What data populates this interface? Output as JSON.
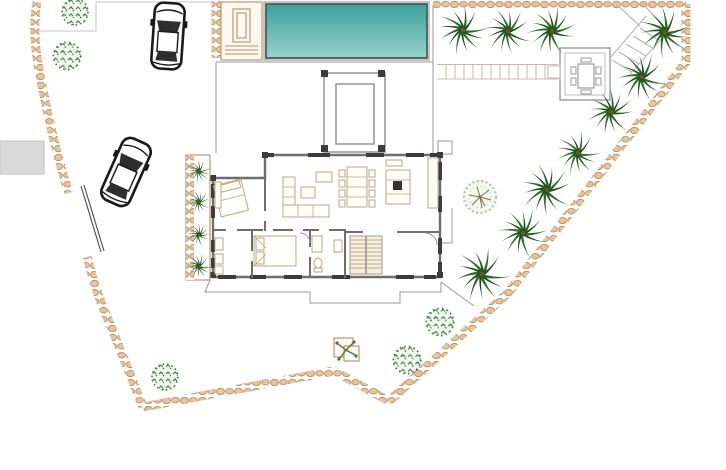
{
  "meta": {
    "title": "Villa site plan with pool and garden",
    "description": "Top-view architectural site plan: villa floor plan with entrance porch, swimming pool, pool house, gazebo, stone boundary wall, driveway with two cars, and palm garden",
    "canvas": {
      "width": 726,
      "height": 470
    }
  },
  "palette": {
    "paper": "#ffffff",
    "pool_top": "#3da09a",
    "pool_bottom": "#96d4cc",
    "pool_edge": "#4f5a5a",
    "stone": "#e6c49c",
    "stone_edge": "#b98e62",
    "wall": "#6e6e6e",
    "wall_dark": "#3c3c3c",
    "furniture": "#b9a88a",
    "palm_green": "#2d6a2a",
    "palm_dark": "#1e4f1e",
    "palm_trunk": "#7a4f26",
    "bush_green": "#3f7a3f",
    "tree_light": "#a9cfa4",
    "branch_brown": "#8a6b4a",
    "car_outline": "#1a1a1a",
    "car_glass": "#2e2e2e",
    "gray_area": "#d9d9d9"
  },
  "inventory": {
    "swimming_pool": 1,
    "house": 1,
    "entrance_porch": 1,
    "pool_house": 1,
    "gazebo_with_table": 1,
    "cars": 2,
    "garden_palm_trees": 10,
    "planter_palm_trees": 4,
    "bushes": 5,
    "round_deciduous_tree": 1,
    "planter_box": 1,
    "stone_wall_segments": 6,
    "driveway_gate": 1,
    "stair_flights": 2
  },
  "scene": {
    "pool": {
      "x": 266,
      "y": 4,
      "w": 161,
      "h": 54
    },
    "garden_palms": [
      [
        463,
        30,
        1.0,
        10
      ],
      [
        508,
        31,
        0.95,
        40
      ],
      [
        552,
        31,
        1.0,
        80
      ],
      [
        665,
        32,
        1.05,
        0
      ],
      [
        642,
        77,
        1.0,
        30
      ],
      [
        611,
        112,
        0.95,
        65
      ],
      [
        578,
        153,
        0.9,
        15
      ],
      [
        547,
        190,
        1.05,
        50
      ],
      [
        523,
        233,
        1.0,
        90
      ],
      [
        482,
        274,
        1.1,
        20
      ]
    ],
    "planter_palms": [
      [
        199,
        171,
        0.5,
        0
      ],
      [
        199,
        202,
        0.5,
        45
      ],
      [
        199,
        235,
        0.5,
        90
      ],
      [
        199,
        266,
        0.55,
        20
      ]
    ],
    "bushes": [
      [
        75,
        12,
        1.0
      ],
      [
        67,
        56,
        1.05
      ],
      [
        165,
        377,
        1.0
      ],
      [
        440,
        322,
        1.05
      ],
      [
        407,
        360,
        1.05
      ]
    ],
    "round_tree": [
      480,
      197
    ],
    "cars": [
      {
        "cx": 168,
        "cy": 36,
        "angle": 4,
        "scale": 1.0
      },
      {
        "cx": 126,
        "cy": 172,
        "angle": 24,
        "scale": 1.02
      }
    ]
  }
}
